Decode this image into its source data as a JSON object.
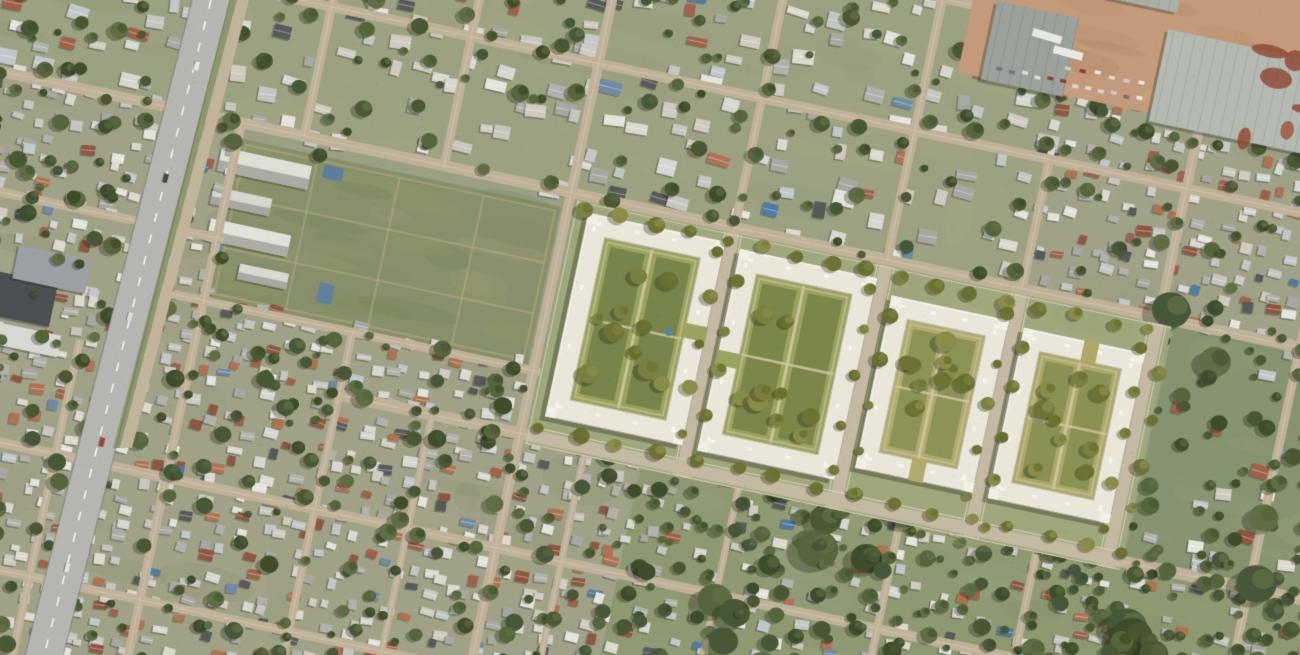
{
  "scene": {
    "width": 1300,
    "height": 655,
    "seed": 1374621,
    "rotation_deg": 12,
    "rotation_center": [
      650,
      327
    ],
    "base_color": "#99a083",
    "palette": {
      "road_dirt": "#c0b29a",
      "road_wear": "#d9cdb0",
      "house_roofs": [
        "#d7d7d1",
        "#c6c6c0",
        "#e4e4de",
        "#b2b2ac",
        "#cfcbc0",
        "#a8a8a2",
        "#dcd9cf",
        "#c2c7c9"
      ],
      "rust_roof": [
        "#a2604a",
        "#b07252",
        "#8f5640"
      ],
      "blue_roof": [
        "#6f8aa6",
        "#4f7ba6"
      ],
      "dark_roof": "#565a58",
      "tree_greens": [
        "#4a5833",
        "#55653c",
        "#3e4d2b",
        "#5f6e44",
        "#47583a"
      ],
      "ground_tints": [
        "#8f9678",
        "#a3a886",
        "#b3ac8d",
        "#7e8a66",
        "#9aa585"
      ]
    },
    "zone_styles": {
      "suburban": {
        "step": 30,
        "houseP": 0.75,
        "minS": 9,
        "maxS": 22,
        "rustP": 0.07,
        "blueP": 0.03,
        "darkP": 0.05,
        "treeP": 0.55,
        "ground": "#9ba181"
      },
      "dense": {
        "step": 19,
        "houseP": 0.88,
        "minS": 7,
        "maxS": 15,
        "rustP": 0.17,
        "blueP": 0.03,
        "darkP": 0.07,
        "treeP": 0.3,
        "ground": "#a0a287"
      },
      "dense-green": {
        "step": 21,
        "houseP": 0.72,
        "minS": 7,
        "maxS": 15,
        "rustP": 0.15,
        "blueP": 0.03,
        "darkP": 0.06,
        "treeP": 0.75,
        "bigTrees": true,
        "ground": "#8e9972"
      },
      "green": {
        "step": 30,
        "houseP": 0.5,
        "minS": 9,
        "maxS": 18,
        "rustP": 0.1,
        "blueP": 0.04,
        "darkP": 0.05,
        "treeP": 1.0,
        "bigTrees": true,
        "ground": "#859370"
      }
    },
    "zones": [
      {
        "name": "north-west",
        "style": "suburban",
        "u": -160,
        "v": -160,
        "w": 700,
        "h": 372
      },
      {
        "name": "north-center",
        "style": "suburban",
        "u": 540,
        "v": -160,
        "w": 470,
        "h": 372
      },
      {
        "name": "north-east",
        "style": "dense",
        "u": 1010,
        "v": -160,
        "w": 450,
        "h": 372
      },
      {
        "name": "west-mid",
        "style": "dense",
        "u": -160,
        "v": 212,
        "w": 368,
        "h": 246
      },
      {
        "name": "field-south",
        "style": "dense",
        "u": 208,
        "v": 394,
        "w": 334,
        "h": 64
      },
      {
        "name": "east-of-dev",
        "style": "green",
        "u": 1162,
        "v": 212,
        "w": 300,
        "h": 246
      },
      {
        "name": "south-west",
        "style": "dense",
        "u": -160,
        "v": 458,
        "w": 830,
        "h": 430
      },
      {
        "name": "south-east",
        "style": "dense-green",
        "u": 670,
        "v": 458,
        "w": 790,
        "h": 430
      }
    ],
    "streets": {
      "horizontal": [
        {
          "v": -55,
          "u0": 520,
          "u1": 905,
          "w": 9
        },
        {
          "v": 80,
          "u0": 60,
          "u1": 1460,
          "w": 10
        },
        {
          "v": 212,
          "u0": -160,
          "u1": 1460,
          "w": 11
        },
        {
          "v": 330,
          "u0": -160,
          "u1": 215,
          "w": 9
        },
        {
          "v": 394,
          "u0": 150,
          "u1": 560,
          "w": 9
        },
        {
          "v": 458,
          "u0": 360,
          "u1": 1460,
          "w": 12
        },
        {
          "v": 575,
          "u0": -160,
          "u1": 1460,
          "w": 10
        },
        {
          "v": 700,
          "u0": -160,
          "u1": 780,
          "w": 9
        },
        {
          "v": 820,
          "u0": -160,
          "u1": 580,
          "w": 9
        }
      ],
      "vertical": [
        {
          "u": 272,
          "v0": -160,
          "v1": 212,
          "w": 9
        },
        {
          "u": 415,
          "v0": -160,
          "v1": 214,
          "w": 9
        },
        {
          "u": 545,
          "v0": -160,
          "v1": 884,
          "w": 10
        },
        {
          "u": 712,
          "v0": -160,
          "v1": 228,
          "w": 9
        },
        {
          "u": 868,
          "v0": -160,
          "v1": 212,
          "w": 9
        },
        {
          "u": 1006,
          "v0": 84,
          "v1": 212,
          "w": 9
        },
        {
          "u": 1146,
          "v0": 16,
          "v1": 212,
          "w": 10
        },
        {
          "u": 1290,
          "v0": 10,
          "v1": 884,
          "w": 9
        },
        {
          "u": 208,
          "v0": 212,
          "v1": 884,
          "w": 9
        },
        {
          "u": 360,
          "v0": 394,
          "v1": 884,
          "w": 8
        },
        {
          "u": 455,
          "v0": 458,
          "v1": 884,
          "w": 7
        },
        {
          "u": 95,
          "v0": 458,
          "v1": 884,
          "w": 8
        },
        {
          "u": 612,
          "v0": 458,
          "v1": 884,
          "w": 7
        },
        {
          "u": 770,
          "v0": 458,
          "v1": 884,
          "w": 7
        },
        {
          "u": 935,
          "v0": 458,
          "v1": 884,
          "w": 8
        },
        {
          "u": 1075,
          "v0": 458,
          "v1": 884,
          "w": 8
        }
      ]
    },
    "field": {
      "u": 212,
      "v": 228,
      "w": 326,
      "h": 162,
      "color": "#87906a",
      "path_color": "#b3a97e",
      "mottle": [
        "#7b855a",
        "#949a6f",
        "#a6a07a",
        "#6f7b52"
      ],
      "v_paths": [
        78,
        162,
        248
      ],
      "h_paths": [
        58,
        110
      ]
    },
    "school_buildings": [
      {
        "u": 194,
        "v": 240,
        "w": 92,
        "h": 24,
        "c": "#dedfd7"
      },
      {
        "u": 194,
        "v": 280,
        "w": 60,
        "h": 18,
        "c": "#d6d7cf"
      },
      {
        "u": 198,
        "v": 312,
        "w": 82,
        "h": 22,
        "c": "#e1e2da"
      },
      {
        "u": 236,
        "v": 350,
        "w": 50,
        "h": 16,
        "c": "#d9dad2"
      }
    ],
    "sheds": [
      {
        "u": 298,
        "v": 236,
        "w": 20,
        "h": 13,
        "c": "#5c7d9c"
      },
      {
        "u": 318,
        "v": 352,
        "w": 15,
        "h": 20,
        "c": "#60809f"
      }
    ],
    "west_buildings": [
      {
        "u": -12,
        "v": 408,
        "w": 74,
        "h": 44,
        "c": "#4b4f52"
      },
      {
        "u": 16,
        "v": 378,
        "w": 74,
        "h": 34,
        "c": "#9aa0a3"
      },
      {
        "u": -10,
        "v": 458,
        "w": 86,
        "h": 22,
        "c": "#d8d8d2"
      }
    ],
    "industrial": {
      "u": 898,
      "v": -170,
      "w": 470,
      "h": 184,
      "dirt": "#c39b7b",
      "dirt_mottle": [
        "#a9805f",
        "#d1ac8b",
        "#b28a67"
      ],
      "rust": [
        "#a0523a",
        "#b06a4e",
        "#8e4530"
      ],
      "buildings": [
        {
          "u": 1095,
          "v": -72,
          "w": 190,
          "h": 94,
          "c": "#b4bab2",
          "rust": true
        },
        {
          "u": 922,
          "v": -64,
          "w": 84,
          "h": 80,
          "c": "#9ba19b",
          "rust": false
        },
        {
          "u": 1030,
          "v": -150,
          "w": 70,
          "h": 60,
          "c": "#aab0a8",
          "rust": false
        }
      ],
      "trailers": [
        [
          978,
          -40,
          0.08
        ],
        [
          1002,
          -28,
          0.05
        ]
      ],
      "vehicle_rows": [
        {
          "u0": 935,
          "u1": 1085,
          "v": 0,
          "step": 13
        },
        {
          "u0": 1002,
          "u1": 1086,
          "v": -16,
          "step": 15
        }
      ],
      "vehicle_colors": [
        "#e8e8e4",
        "#d2d6da",
        "#4a4e52",
        "#93392e",
        "#dcdcd4",
        "#70747a",
        "#c8cdd2"
      ]
    },
    "development": {
      "ground": {
        "u": 552,
        "v": 218,
        "w": 608,
        "h": 249,
        "c": "#9fa87d"
      },
      "ground_mottle": [
        "#a9b086",
        "#94a071",
        "#b7b391"
      ],
      "street_color": "#c4b9a2",
      "sidewalk_color": "#dbd5c0",
      "streets": [
        {
          "o": "v",
          "p": 712
        },
        {
          "o": "v",
          "p": 868
        },
        {
          "o": "v",
          "p": 1006
        },
        {
          "o": "v",
          "p": 1146
        },
        {
          "o": "h",
          "p": 458
        }
      ],
      "blocks": [
        {
          "u": 566,
          "v": 228,
          "w": 140,
          "h": 208,
          "ring": 21,
          "courtyard": "#9aa35e",
          "lawn": "#75834a",
          "gap": "right",
          "pool": true,
          "trees": 10
        },
        {
          "u": 722,
          "v": 232,
          "w": 140,
          "h": 206,
          "ring": 21,
          "courtyard": "#9aa35f",
          "lawn": "#788549",
          "gap": "left",
          "pool": false,
          "trees": 10
        },
        {
          "u": 880,
          "v": 246,
          "w": 120,
          "h": 176,
          "ring": 20,
          "courtyard": "#b1ab6e",
          "lawn": "#8a9154",
          "gap": "bottom",
          "pool": false,
          "trees": 9
        },
        {
          "u": 1016,
          "v": 250,
          "w": 124,
          "h": 174,
          "ring": 20,
          "courtyard": "#ada768",
          "lawn": "#879053",
          "gap": "top",
          "pool": false,
          "trees": 9
        }
      ],
      "building_fill": "#eae7da",
      "building_light": "#f6f4ea",
      "building_shade": "#c2bfb0",
      "shadow": "rgba(45,50,32,0.38)",
      "path_color": "#cfc7a2",
      "walk_color": "#c8c09a",
      "pool_color": "#4e87ab",
      "tree_olive": [
        "#6e7335",
        "#7b8040",
        "#67702f",
        "#8a8c4a"
      ]
    },
    "avenue": {
      "road": [
        [
          192,
          0
        ],
        [
          230,
          0
        ],
        [
          62,
          660
        ],
        [
          24,
          660
        ]
      ],
      "color": "#b5b5b1",
      "median": [
        [
          230,
          0
        ],
        [
          237,
          0
        ],
        [
          120,
          448
        ],
        [
          113,
          448
        ]
      ],
      "median_color": "#8d976f",
      "service_road": [
        [
          237,
          0
        ],
        [
          249,
          0
        ],
        [
          132,
          448
        ],
        [
          120,
          448
        ]
      ],
      "service_color": "#c2b49b",
      "dash_color": "rgba(255,255,255,0.85)",
      "edge_color": "rgba(80,80,75,0.35)",
      "cars": [
        {
          "t": 0.1,
          "c": "#e8e8e6"
        },
        {
          "t": 0.27,
          "c": "#43474b"
        },
        {
          "t": 0.48,
          "c": "#dcdcda"
        },
        {
          "t": 0.67,
          "c": "#9d3d32"
        },
        {
          "t": 0.86,
          "c": "#e2e2de"
        }
      ]
    },
    "grain": {
      "count": 3000
    }
  }
}
